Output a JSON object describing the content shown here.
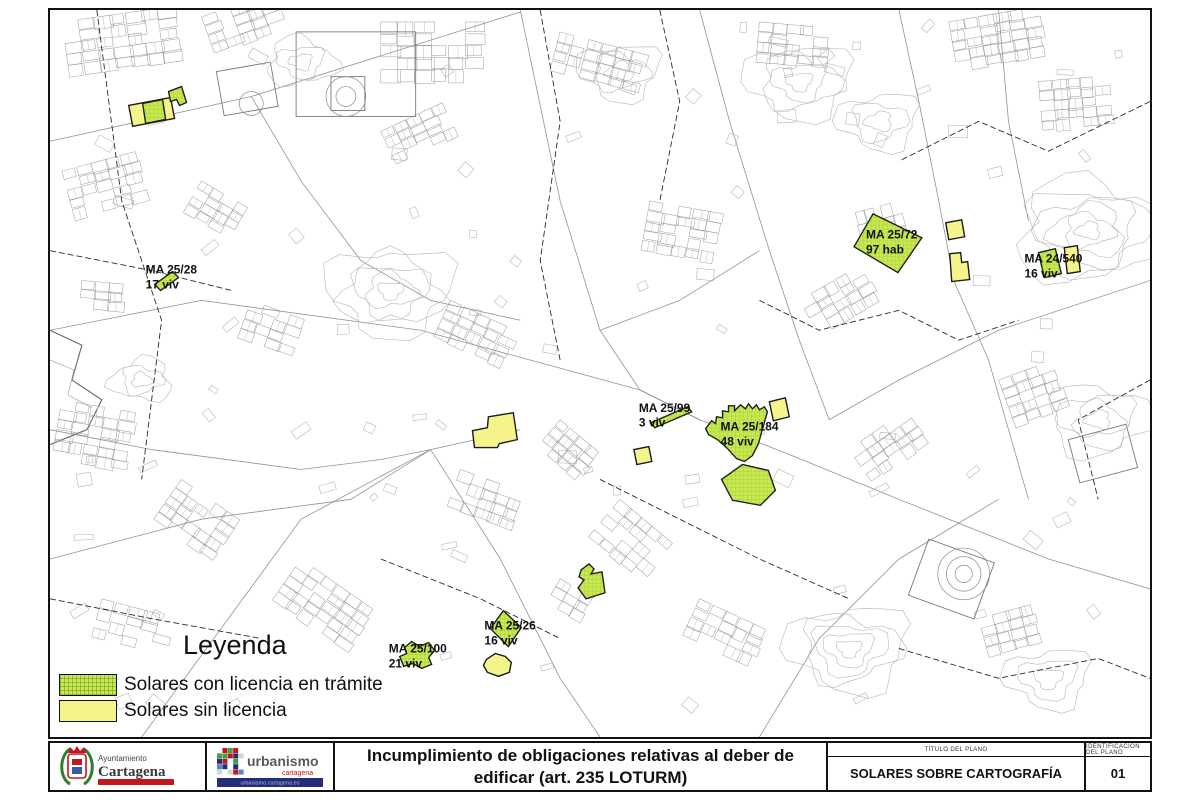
{
  "legend": {
    "title": "Leyenda",
    "items": [
      {
        "label": "Solares con licencia en trámite",
        "fill": "#c8e94f",
        "pattern": "crosshatch"
      },
      {
        "label": "Solares sin licencia",
        "fill": "#f5f48b",
        "pattern": "solid"
      }
    ]
  },
  "colors": {
    "parcel_green": "#c8e94f",
    "parcel_green_hatch": "#7da52b",
    "parcel_yellow": "#f5f48b",
    "parcel_outline": "#1a1a1a",
    "brand_red": "#c4161c",
    "brand_blue": "#232e7a"
  },
  "map_labels": [
    {
      "line1": "MA 25/28",
      "line2": "17 viv",
      "x": 144,
      "y": 273
    },
    {
      "line1": "MA 25/72",
      "line2": "97 hab",
      "x": 867,
      "y": 238
    },
    {
      "line1": "MA 24/540",
      "line2": "16 viv",
      "x": 1026,
      "y": 262
    },
    {
      "line1": "MA 25/99",
      "line2": "3 viv",
      "x": 639,
      "y": 412
    },
    {
      "line1": "MA 25/184",
      "line2": "48 viv",
      "x": 721,
      "y": 431
    },
    {
      "line1": "MA 25/26",
      "line2": "16 viv",
      "x": 484,
      "y": 631
    },
    {
      "line1": "MA 25/100",
      "line2": "21 viv",
      "x": 388,
      "y": 654
    }
  ],
  "parcels": [
    {
      "status": "sin_licencia",
      "points": [
        [
          127,
          104
        ],
        [
          169,
          96
        ],
        [
          173,
          117
        ],
        [
          131,
          125
        ]
      ]
    },
    {
      "status": "sin_licencia",
      "points": [
        [
          947,
          222
        ],
        [
          963,
          219
        ],
        [
          966,
          236
        ],
        [
          950,
          239
        ]
      ]
    },
    {
      "status": "sin_licencia",
      "points": [
        [
          951,
          253
        ],
        [
          962,
          252
        ],
        [
          963,
          262
        ],
        [
          969,
          261
        ],
        [
          971,
          279
        ],
        [
          953,
          281
        ]
      ]
    },
    {
      "status": "sin_licencia",
      "points": [
        [
          1066,
          247
        ],
        [
          1079,
          245
        ],
        [
          1082,
          271
        ],
        [
          1069,
          273
        ]
      ]
    },
    {
      "status": "sin_licencia",
      "points": [
        [
          488,
          417
        ],
        [
          513,
          413
        ],
        [
          517,
          440
        ],
        [
          499,
          444
        ],
        [
          497,
          448
        ],
        [
          474,
          448
        ],
        [
          472,
          431
        ],
        [
          487,
          428
        ]
      ]
    },
    {
      "status": "sin_licencia",
      "points": [
        [
          634,
          450
        ],
        [
          649,
          447
        ],
        [
          652,
          462
        ],
        [
          637,
          465
        ]
      ]
    },
    {
      "status": "sin_licencia",
      "points": [
        [
          770,
          402
        ],
        [
          786,
          398
        ],
        [
          790,
          417
        ],
        [
          774,
          421
        ]
      ]
    },
    {
      "status": "sin_licencia",
      "points": [
        [
          486,
          661
        ],
        [
          495,
          655
        ],
        [
          505,
          658
        ],
        [
          511,
          664
        ],
        [
          509,
          674
        ],
        [
          498,
          678
        ],
        [
          487,
          674
        ],
        [
          483,
          667
        ]
      ]
    },
    {
      "status": "licencia_en_tramite",
      "points": [
        [
          141,
          102
        ],
        [
          161,
          98
        ],
        [
          164,
          118
        ],
        [
          144,
          122
        ]
      ]
    },
    {
      "status": "licencia_en_tramite",
      "points": [
        [
          167,
          90
        ],
        [
          180,
          85
        ],
        [
          185,
          101
        ],
        [
          178,
          104
        ],
        [
          175,
          98
        ],
        [
          169,
          100
        ]
      ]
    },
    {
      "status": "licencia_en_tramite",
      "points": [
        [
          153,
          284
        ],
        [
          171,
          271
        ],
        [
          177,
          277
        ],
        [
          159,
          290
        ]
      ]
    },
    {
      "status": "licencia_en_tramite",
      "points": [
        [
          874,
          213
        ],
        [
          923,
          237
        ],
        [
          899,
          272
        ],
        [
          855,
          246
        ]
      ]
    },
    {
      "status": "licencia_en_tramite",
      "points": [
        [
          1040,
          252
        ],
        [
          1057,
          248
        ],
        [
          1063,
          273
        ],
        [
          1046,
          277
        ]
      ]
    },
    {
      "status": "licencia_en_tramite",
      "points": [
        [
          651,
          423
        ],
        [
          688,
          407
        ],
        [
          692,
          412
        ],
        [
          655,
          428
        ]
      ]
    },
    {
      "status": "licencia_en_tramite",
      "points": [
        [
          706,
          429
        ],
        [
          712,
          421
        ],
        [
          716,
          424
        ],
        [
          717,
          417
        ],
        [
          723,
          418
        ],
        [
          723,
          411
        ],
        [
          729,
          412
        ],
        [
          729,
          406
        ],
        [
          735,
          406
        ],
        [
          735,
          411
        ],
        [
          741,
          405
        ],
        [
          746,
          409
        ],
        [
          749,
          404
        ],
        [
          753,
          409
        ],
        [
          757,
          405
        ],
        [
          760,
          410
        ],
        [
          765,
          407
        ],
        [
          768,
          412
        ],
        [
          764,
          426
        ],
        [
          759,
          444
        ],
        [
          753,
          456
        ],
        [
          745,
          462
        ],
        [
          737,
          459
        ],
        [
          728,
          449
        ],
        [
          718,
          440
        ],
        [
          709,
          435
        ]
      ]
    },
    {
      "status": "licencia_en_tramite",
      "points": [
        [
          722,
          480
        ],
        [
          743,
          465
        ],
        [
          769,
          471
        ],
        [
          776,
          491
        ],
        [
          761,
          506
        ],
        [
          733,
          501
        ]
      ]
    },
    {
      "status": "licencia_en_tramite",
      "points": [
        [
          581,
          571
        ],
        [
          589,
          565
        ],
        [
          594,
          570
        ],
        [
          591,
          575
        ],
        [
          602,
          573
        ],
        [
          605,
          594
        ],
        [
          586,
          600
        ],
        [
          578,
          589
        ],
        [
          584,
          581
        ],
        [
          579,
          578
        ]
      ]
    },
    {
      "status": "licencia_en_tramite",
      "points": [
        [
          503,
          612
        ],
        [
          521,
          629
        ],
        [
          508,
          648
        ],
        [
          490,
          630
        ]
      ]
    },
    {
      "status": "licencia_en_tramite",
      "points": [
        [
          404,
          649
        ],
        [
          411,
          643
        ],
        [
          419,
          648
        ],
        [
          428,
          644
        ],
        [
          434,
          652
        ],
        [
          428,
          659
        ],
        [
          431,
          666
        ],
        [
          421,
          670
        ],
        [
          412,
          665
        ],
        [
          403,
          668
        ],
        [
          399,
          658
        ],
        [
          406,
          655
        ]
      ]
    }
  ],
  "footer": {
    "title_line1": "Incumplimiento de obligaciones relativas al deber de",
    "title_line2": "edificar (art. 235 LOTURM)",
    "plan_title_label": "TÍTULO DEL PLANO",
    "plan_title": "SOLARES SOBRE CARTOGRAFÍA",
    "plan_id_label": "IDENTIFICACIÓN DEL PLANO",
    "plan_id": "01",
    "logo_ayto": {
      "line1": "Ayuntamiento",
      "line2": "Cartagena"
    },
    "logo_urb": {
      "line1": "urbanismo",
      "line2": "cartagena",
      "line3": "urbanismo.cartagena.es"
    }
  }
}
